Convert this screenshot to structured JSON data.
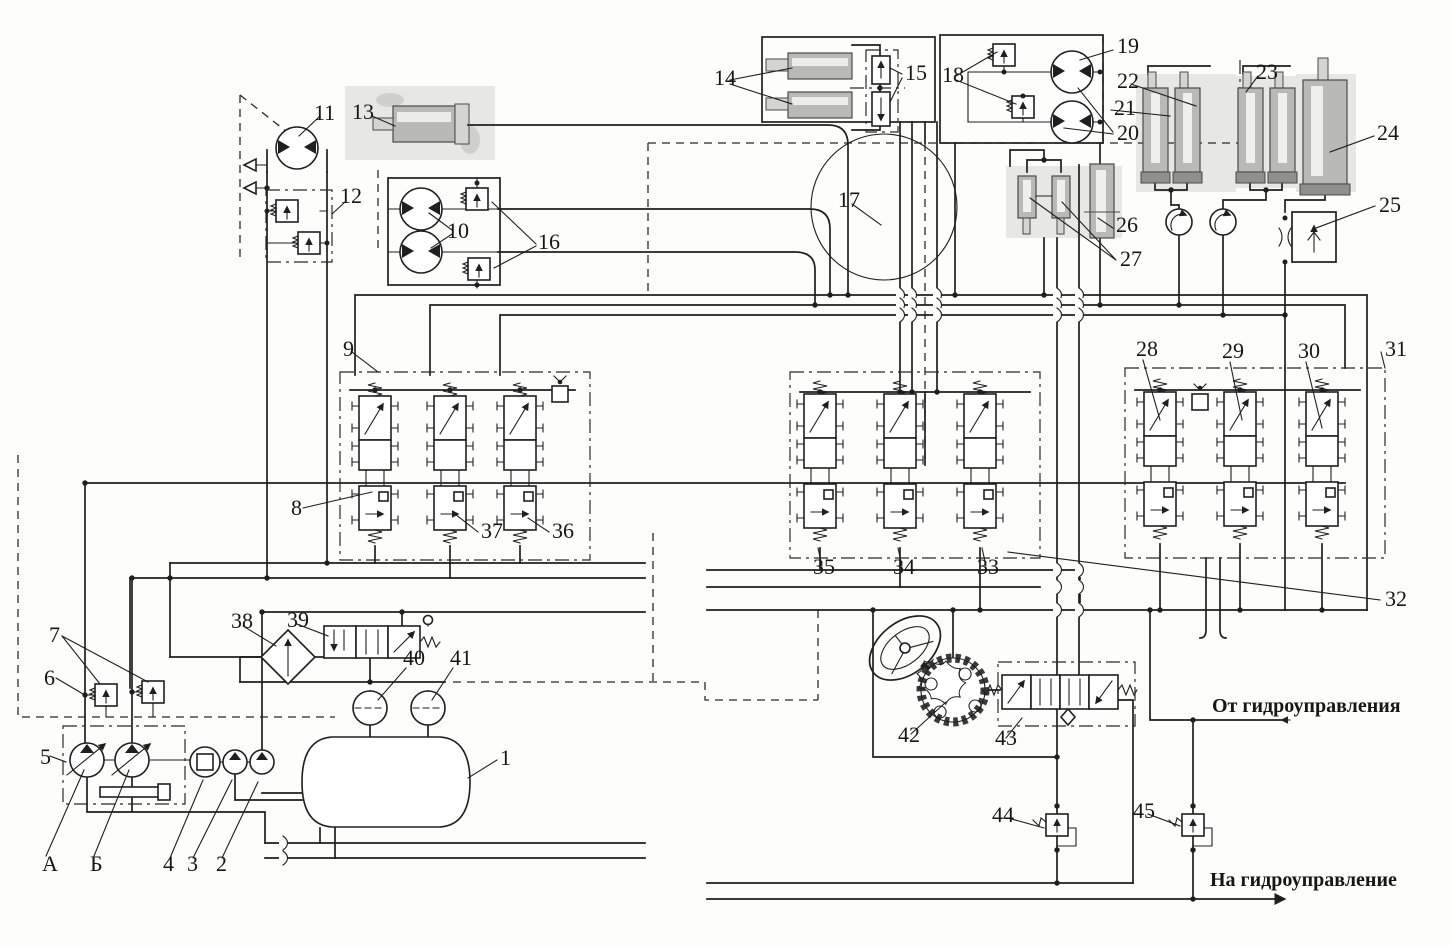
{
  "diagram": {
    "kind": "hydraulic-circuit-schematic",
    "language": "ru",
    "line_color": "#1f1f1f",
    "photo_fill": "#b9b9b7"
  },
  "annotations": {
    "from_pilot": "От  гидроуправления",
    "to_pilot": "На  гидроуправление"
  },
  "labels": {
    "1": {
      "text": "1",
      "x": 500,
      "y": 765
    },
    "2": {
      "text": "2",
      "x": 216,
      "y": 871
    },
    "3": {
      "text": "3",
      "x": 187,
      "y": 871
    },
    "4": {
      "text": "4",
      "x": 163,
      "y": 871
    },
    "5": {
      "text": "5",
      "x": 40,
      "y": 764
    },
    "6": {
      "text": "6",
      "x": 44,
      "y": 685
    },
    "7": {
      "text": "7",
      "x": 49,
      "y": 642
    },
    "8": {
      "text": "8",
      "x": 291,
      "y": 515
    },
    "9": {
      "text": "9",
      "x": 343,
      "y": 356
    },
    "10": {
      "text": "10",
      "x": 447,
      "y": 238
    },
    "11": {
      "text": "11",
      "x": 314,
      "y": 120
    },
    "12": {
      "text": "12",
      "x": 340,
      "y": 203
    },
    "13": {
      "text": "13",
      "x": 352,
      "y": 119
    },
    "14": {
      "text": "14",
      "x": 714,
      "y": 85
    },
    "15": {
      "text": "15",
      "x": 905,
      "y": 80
    },
    "16": {
      "text": "16",
      "x": 538,
      "y": 249
    },
    "17": {
      "text": "17",
      "x": 838,
      "y": 207
    },
    "18": {
      "text": "18",
      "x": 942,
      "y": 82
    },
    "19": {
      "text": "19",
      "x": 1117,
      "y": 53
    },
    "20": {
      "text": "20",
      "x": 1117,
      "y": 140
    },
    "21": {
      "text": "21",
      "x": 1114,
      "y": 115
    },
    "22": {
      "text": "22",
      "x": 1117,
      "y": 88
    },
    "23": {
      "text": "23",
      "x": 1256,
      "y": 79
    },
    "24": {
      "text": "24",
      "x": 1377,
      "y": 140
    },
    "25": {
      "text": "25",
      "x": 1379,
      "y": 212
    },
    "26": {
      "text": "26",
      "x": 1116,
      "y": 232
    },
    "27": {
      "text": "27",
      "x": 1120,
      "y": 266
    },
    "28": {
      "text": "28",
      "x": 1136,
      "y": 356
    },
    "29": {
      "text": "29",
      "x": 1222,
      "y": 358
    },
    "30": {
      "text": "30",
      "x": 1298,
      "y": 358
    },
    "31": {
      "text": "31",
      "x": 1385,
      "y": 356
    },
    "32": {
      "text": "32",
      "x": 1385,
      "y": 606
    },
    "33": {
      "text": "33",
      "x": 977,
      "y": 574
    },
    "34": {
      "text": "34",
      "x": 893,
      "y": 574
    },
    "35": {
      "text": "35",
      "x": 813,
      "y": 574
    },
    "36": {
      "text": "36",
      "x": 552,
      "y": 538
    },
    "37": {
      "text": "37",
      "x": 481,
      "y": 538
    },
    "38": {
      "text": "38",
      "x": 231,
      "y": 628
    },
    "39": {
      "text": "39",
      "x": 287,
      "y": 627
    },
    "40": {
      "text": "40",
      "x": 403,
      "y": 665
    },
    "41": {
      "text": "41",
      "x": 450,
      "y": 665
    },
    "42": {
      "text": "42",
      "x": 898,
      "y": 742
    },
    "43": {
      "text": "43",
      "x": 995,
      "y": 745
    },
    "44": {
      "text": "44",
      "x": 992,
      "y": 822
    },
    "45": {
      "text": "45",
      "x": 1133,
      "y": 818
    },
    "A": {
      "text": "А",
      "x": 42,
      "y": 871
    },
    "B": {
      "text": "Б",
      "x": 90,
      "y": 871
    },
    "from_pilot": {
      "text": "От  гидроуправления",
      "x": 1212,
      "y": 712,
      "ru": true
    },
    "to_pilot": {
      "text": "На  гидроуправление",
      "x": 1210,
      "y": 886,
      "ru": true
    }
  }
}
